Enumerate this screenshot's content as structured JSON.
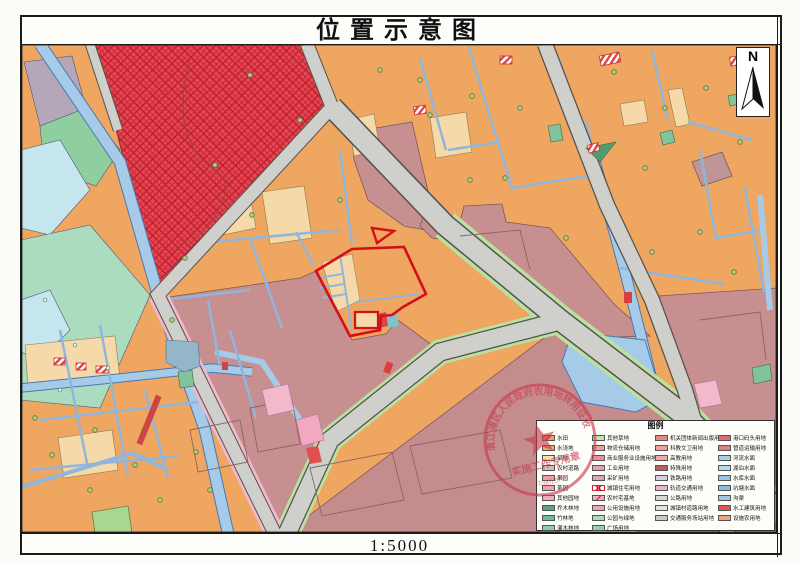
{
  "page": {
    "title": "位置示意图",
    "scale_label": "1:5000",
    "north_label": "N"
  },
  "stamp": {
    "arc_text": "清江浦区人民政府农用地转用征收",
    "line_text": "实施工作专用章",
    "code": "32061200"
  },
  "legend": {
    "title": "图例",
    "columns": [
      {
        "items": [
          {
            "label": "水田",
            "color": "#f0a25a",
            "pattern": "diag"
          },
          {
            "label": "水浇地",
            "color": "#f0ad62",
            "pattern": ""
          },
          {
            "label": "旱地",
            "color": "#f7e0a6",
            "pattern": ""
          },
          {
            "label": "农村道路",
            "color": "#d9b8bc",
            "pattern": ""
          },
          {
            "label": "果园",
            "color": "#ef9aa6",
            "pattern": ""
          },
          {
            "label": "茶园",
            "color": "#e8a2b0",
            "pattern": ""
          },
          {
            "label": "其他园地",
            "color": "#eeadb8",
            "pattern": ""
          },
          {
            "label": "乔木林地",
            "color": "#55a87e",
            "pattern": ""
          },
          {
            "label": "竹林地",
            "color": "#6fbd92",
            "pattern": ""
          },
          {
            "label": "灌木林地",
            "color": "#8ccfa6",
            "pattern": ""
          }
        ]
      },
      {
        "items": [
          {
            "label": "其他草地",
            "color": "#c2e5b0",
            "pattern": ""
          },
          {
            "label": "物流仓储用地",
            "color": "#ef9f9f",
            "pattern": ""
          },
          {
            "label": "商业服务业设施用地",
            "color": "#f08f8f",
            "pattern": ""
          },
          {
            "label": "工业用地",
            "color": "#e7a0a6",
            "pattern": ""
          },
          {
            "label": "采矿用地",
            "color": "#d8a8b0",
            "pattern": ""
          },
          {
            "label": "城镇住宅用地",
            "color": "#ffffff",
            "pattern": "cross"
          },
          {
            "label": "农村宅基地",
            "color": "#f3aab4",
            "pattern": "diag"
          },
          {
            "label": "公用设施用地",
            "color": "#f2a2b2",
            "pattern": ""
          },
          {
            "label": "公园与绿地",
            "color": "#a8dcb4",
            "pattern": ""
          },
          {
            "label": "广场用地",
            "color": "#8ed3a8",
            "pattern": ""
          }
        ]
      },
      {
        "items": [
          {
            "label": "机关团体新闻出版用地",
            "color": "#ee8585",
            "pattern": ""
          },
          {
            "label": "科教文卫用地",
            "color": "#f29c9c",
            "pattern": ""
          },
          {
            "label": "高教用地",
            "color": "#f2a8a8",
            "pattern": ""
          },
          {
            "label": "特殊用地",
            "color": "#b65f63",
            "pattern": ""
          },
          {
            "label": "铁路用地",
            "color": "#d9cede",
            "pattern": ""
          },
          {
            "label": "轨道交通用地",
            "color": "#e3b6c8",
            "pattern": ""
          },
          {
            "label": "公路用地",
            "color": "#d6d6d4",
            "pattern": ""
          },
          {
            "label": "城镇村道路用地",
            "color": "#e2e2e0",
            "pattern": ""
          },
          {
            "label": "交通服务场站用地",
            "color": "#c9c9c7",
            "pattern": ""
          }
        ]
      },
      {
        "items": [
          {
            "label": "港口码头用地",
            "color": "#e26a6a",
            "pattern": ""
          },
          {
            "label": "管道运输用地",
            "color": "#de8080",
            "pattern": ""
          },
          {
            "label": "河流水面",
            "color": "#aacdec",
            "pattern": ""
          },
          {
            "label": "湖泊水面",
            "color": "#b8d8f0",
            "pattern": ""
          },
          {
            "label": "水库水面",
            "color": "#9cc4e8",
            "pattern": ""
          },
          {
            "label": "坑塘水面",
            "color": "#8cbce2",
            "pattern": ""
          },
          {
            "label": "沟渠",
            "color": "#a2c6e6",
            "pattern": ""
          },
          {
            "label": "水工建筑用地",
            "color": "#e25555",
            "pattern": ""
          },
          {
            "label": "设施农用地",
            "color": "#e9a87e",
            "pattern": ""
          }
        ]
      }
    ]
  },
  "palette": {
    "land_orange": "#efa660",
    "land_tan": "#f6d9a8",
    "urban_mauve": "#c78f90",
    "road_gray": "#cfcfcb",
    "canal_blue": "#a6cbe8",
    "green_strip": "#b9e2a2",
    "red_zone": "#e8474f",
    "target_outline": "#d40f1a",
    "stamp_red": "#c63a4a"
  }
}
